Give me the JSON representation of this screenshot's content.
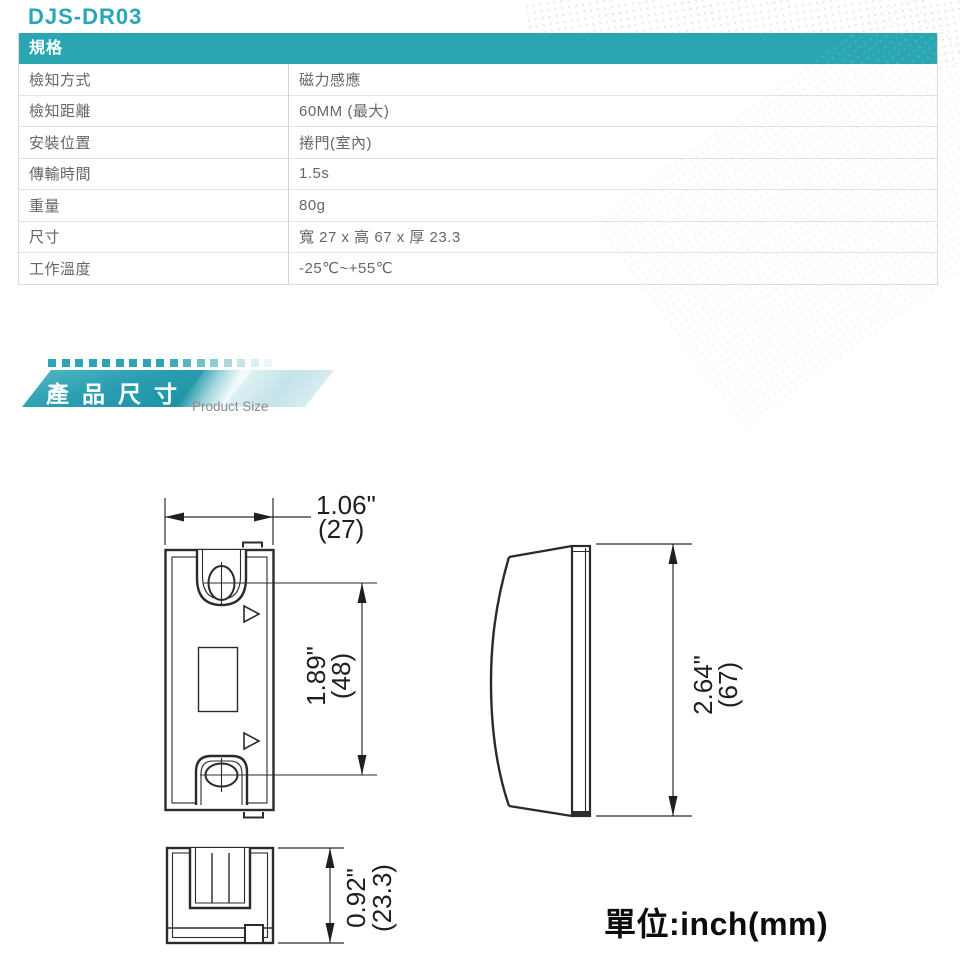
{
  "page": {
    "title": "DJS-DR03"
  },
  "spec_table": {
    "header": "規格",
    "rows": [
      {
        "label": "檢知方式",
        "value": "磁力感應"
      },
      {
        "label": "檢知距離",
        "value": "60MM (最大)"
      },
      {
        "label": "安裝位置",
        "value": "捲門(室內)"
      },
      {
        "label": "傳輸時間",
        "value": "1.5s"
      },
      {
        "label": "重量",
        "value": "80g"
      },
      {
        "label": "尺寸",
        "value": "寬 27 x 高 67 x 厚 23.3"
      },
      {
        "label": "工作溫度",
        "value": "-25℃~+55℃"
      }
    ]
  },
  "section_banner": {
    "title_zh": "產品尺寸",
    "title_en": "Product Size",
    "square_colors": [
      "#2ea4b4",
      "#2ea4b4",
      "#2ea4b4",
      "#2ea4b4",
      "#2ea4b4",
      "#2ea4b4",
      "#2ea4b4",
      "#2ea4b4",
      "#2ea4b4",
      "#3faab9",
      "#58b4c1",
      "#74c0cb",
      "#90ccd5",
      "#abd8df",
      "#c4e4e9",
      "#d9eef1",
      "#eaf6f8"
    ]
  },
  "diagram": {
    "front_view": {
      "width_dim": {
        "inch": "1.06\"",
        "mm": "(27)"
      },
      "hole_pitch_dim": {
        "inch": "1.89\"",
        "mm": "(48)"
      }
    },
    "side_view": {
      "height_dim": {
        "inch": "2.64\"",
        "mm": "(67)"
      }
    },
    "bottom_view": {
      "depth_dim": {
        "inch": "0.92\"",
        "mm": "(23.3)"
      }
    },
    "unit_label": "單位:inch(mm)"
  },
  "colors": {
    "accent_teal": "#2aa6b2",
    "title_teal": "#2ba6b8",
    "table_border": "#dcdcdc",
    "table_text": "#666666",
    "drawing_line": "#2b2b2b"
  }
}
